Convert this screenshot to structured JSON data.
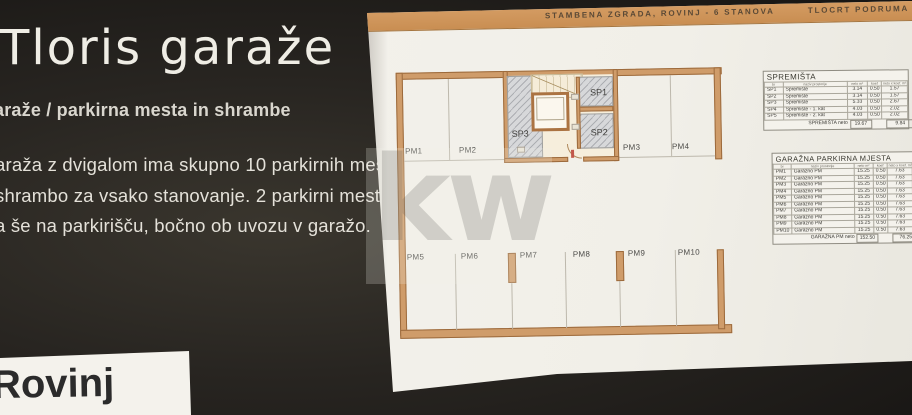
{
  "panel": {
    "title": "Tloris garaže",
    "subtitle": "araže / parkirna mesta in shrambe",
    "body_lines": [
      "araža z dvigalom ima skupno 10 parkirnih mest",
      "shrambo za vsako stanovanje. 2 parkirni mesti",
      "a še na parkirišču, bočno ob uvozu v garažo."
    ],
    "footer": "Rovinj"
  },
  "document": {
    "header": {
      "left": "STAMBENA ZGRADA, ROVINJ - 6 STANOVA",
      "right": "TLOCRT PODRUMA"
    },
    "plan": {
      "parking_labels": [
        "PM1",
        "PM2",
        "PM3",
        "PM4",
        "PM5",
        "PM6",
        "PM7",
        "PM8",
        "PM9",
        "PM10"
      ],
      "storage_labels": [
        "SP1",
        "SP2",
        "SP3"
      ]
    },
    "tables": {
      "spremista": {
        "title": "SPREMIŠTA",
        "columns": [
          "br",
          "naziv prostorije",
          "neto m²",
          "koef",
          "neto x koef. m²"
        ],
        "rows": [
          [
            "SP1",
            "Spremište",
            "3.14",
            "0.50",
            "1.57"
          ],
          [
            "SP2",
            "Spremište",
            "3.14",
            "0.50",
            "1.57"
          ],
          [
            "SP3",
            "Spremište",
            "5.33",
            "0.50",
            "2.67"
          ],
          [
            "SP4",
            "Spremište - 1. kat",
            "4.03",
            "0.50",
            "2.02"
          ],
          [
            "SP5",
            "Spremište - 2. kat",
            "4.03",
            "0.50",
            "2.02"
          ]
        ],
        "total": {
          "label": "SPREMIŠTA neto",
          "neto": "19.67",
          "sum": "9.84"
        }
      },
      "garazna": {
        "title": "GARAŽNA PARKIRNA MJESTA",
        "columns": [
          "br",
          "naziv prostorije",
          "neto m²",
          "koef",
          "neto x koef. m²"
        ],
        "rows": [
          [
            "PM1",
            "Garažno PM",
            "15.25",
            "0.50",
            "7.63"
          ],
          [
            "PM2",
            "Garažno PM",
            "15.25",
            "0.50",
            "7.63"
          ],
          [
            "PM3",
            "Garažno PM",
            "15.25",
            "0.50",
            "7.63"
          ],
          [
            "PM4",
            "Garažno PM",
            "15.25",
            "0.50",
            "7.63"
          ],
          [
            "PM5",
            "Garažno PM",
            "15.25",
            "0.50",
            "7.63"
          ],
          [
            "PM6",
            "Garažno PM",
            "15.25",
            "0.50",
            "7.63"
          ],
          [
            "PM7",
            "Garažno PM",
            "15.25",
            "0.50",
            "7.63"
          ],
          [
            "PM8",
            "Garažno PM",
            "15.25",
            "0.50",
            "7.63"
          ],
          [
            "PM9",
            "Garažno PM",
            "15.25",
            "0.50",
            "7.63"
          ],
          [
            "PM10",
            "Garažno PM",
            "15.25",
            "0.50",
            "7.63"
          ]
        ],
        "total": {
          "label": "GARAŽNA PM neto",
          "neto": "152.50",
          "sum": "76.25"
        }
      }
    }
  },
  "watermark": {
    "text": "kw"
  },
  "colors": {
    "panel_bg": "#282521",
    "paper": "#f2f0ea",
    "header_bar": "#cf9459",
    "wall_fill": "#cf9c6a",
    "wall_border": "#9c6a3c",
    "hatch_gray": "#d7d8da",
    "floor_cream": "#f6eedc"
  }
}
